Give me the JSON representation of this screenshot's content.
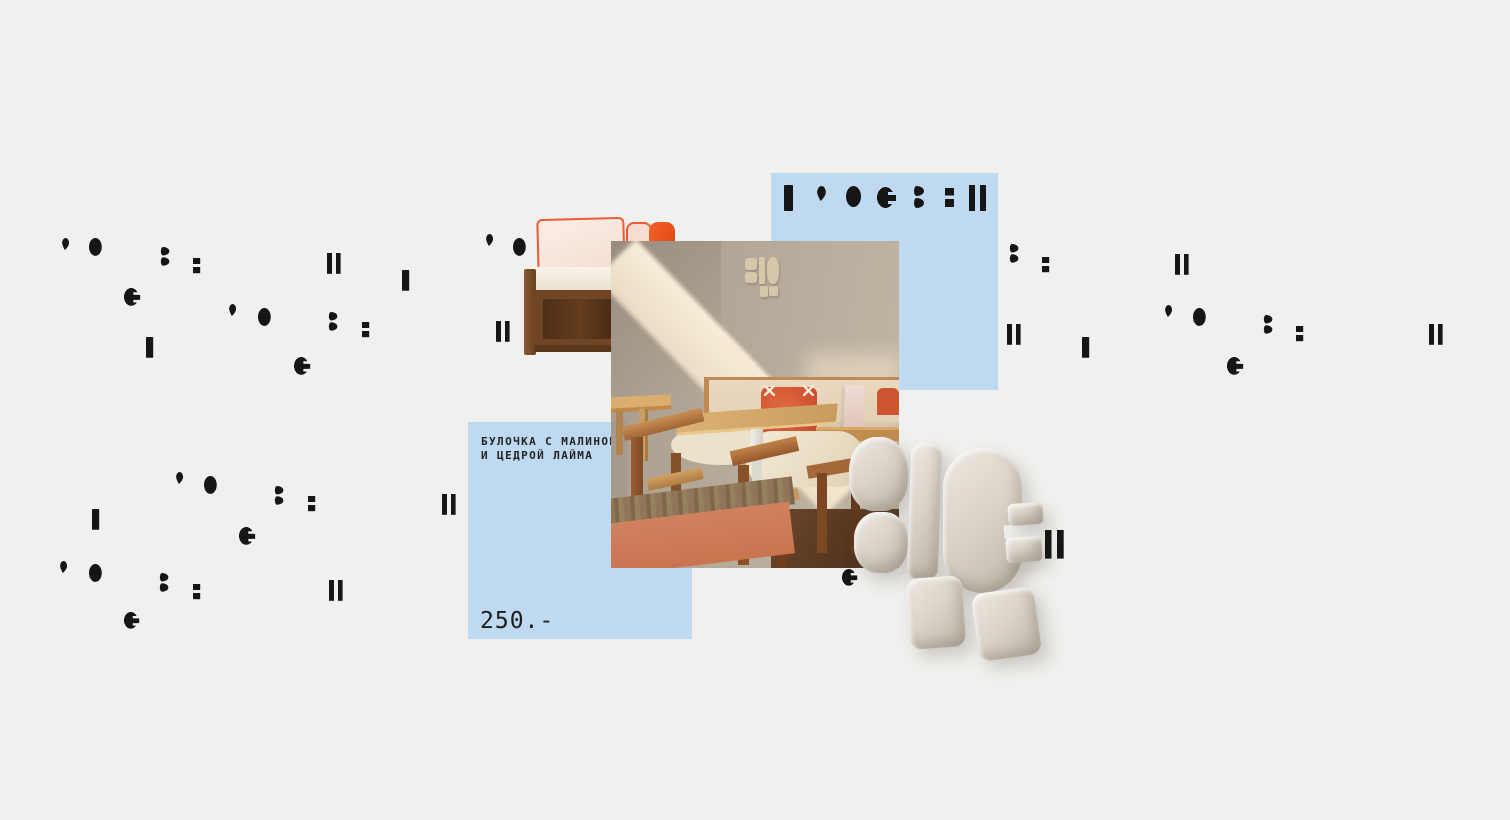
{
  "canvas": {
    "width": 1510,
    "height": 820,
    "background": "#f0f0ee"
  },
  "colors": {
    "accent_blue": "#bed9f0",
    "glyph_black": "#161616",
    "logo_beige": "#d9d2c7",
    "terracotta": "#cd7a5c",
    "wood_oak": "#a06536"
  },
  "product_card": {
    "title_line1": "БУЛОЧКА С МАЛИНОЙ,",
    "title_line2": "И ЦЕДРОЙ ЛАЙМА",
    "price": "250.-"
  },
  "glyph_types": {
    "bar": "vertical-bar-glyph",
    "dbar": "double-bar-glyph",
    "oval": "oval-dot-glyph",
    "apos": "apostrophe-glyph",
    "cnotch": "notched-circle-glyph",
    "z3": "double-comma-glyph",
    "esq": "stacked-squares-glyph"
  },
  "glyphs": [
    {
      "t": "bar",
      "x": 784,
      "y": 185,
      "s": 1
    },
    {
      "t": "apos",
      "x": 817,
      "y": 186,
      "s": 1
    },
    {
      "t": "oval",
      "x": 846,
      "y": 186,
      "s": 1
    },
    {
      "t": "cnotch",
      "x": 877,
      "y": 187,
      "s": 1,
      "blue": true
    },
    {
      "t": "z3",
      "x": 913,
      "y": 186,
      "s": 1
    },
    {
      "t": "esq",
      "x": 945,
      "y": 188,
      "s": 1
    },
    {
      "t": "dbar",
      "x": 969,
      "y": 185,
      "s": 1
    },
    {
      "t": "apos",
      "x": 62,
      "y": 238,
      "s": 0.8
    },
    {
      "t": "oval",
      "x": 89,
      "y": 238,
      "s": 0.85
    },
    {
      "t": "z3",
      "x": 160,
      "y": 247,
      "s": 0.85
    },
    {
      "t": "esq",
      "x": 193,
      "y": 258,
      "s": 0.8
    },
    {
      "t": "dbar",
      "x": 327,
      "y": 253,
      "s": 0.8
    },
    {
      "t": "bar",
      "x": 402,
      "y": 270,
      "s": 0.8
    },
    {
      "t": "cnotch",
      "x": 124,
      "y": 288,
      "s": 0.85
    },
    {
      "t": "bar",
      "x": 146,
      "y": 337,
      "s": 0.8
    },
    {
      "t": "apos",
      "x": 229,
      "y": 304,
      "s": 0.8
    },
    {
      "t": "oval",
      "x": 258,
      "y": 308,
      "s": 0.85
    },
    {
      "t": "z3",
      "x": 328,
      "y": 312,
      "s": 0.85
    },
    {
      "t": "esq",
      "x": 362,
      "y": 322,
      "s": 0.8
    },
    {
      "t": "cnotch",
      "x": 294,
      "y": 357,
      "s": 0.85
    },
    {
      "t": "apos",
      "x": 486,
      "y": 234,
      "s": 0.8
    },
    {
      "t": "oval",
      "x": 513,
      "y": 238,
      "s": 0.85
    },
    {
      "t": "dbar",
      "x": 496,
      "y": 321,
      "s": 0.8
    },
    {
      "t": "z3",
      "x": 1009,
      "y": 244,
      "s": 0.85
    },
    {
      "t": "esq",
      "x": 1042,
      "y": 257,
      "s": 0.8
    },
    {
      "t": "dbar",
      "x": 1175,
      "y": 254,
      "s": 0.8
    },
    {
      "t": "dbar",
      "x": 1007,
      "y": 324,
      "s": 0.8
    },
    {
      "t": "bar",
      "x": 1082,
      "y": 337,
      "s": 0.8
    },
    {
      "t": "apos",
      "x": 1165,
      "y": 305,
      "s": 0.8
    },
    {
      "t": "oval",
      "x": 1193,
      "y": 308,
      "s": 0.85
    },
    {
      "t": "z3",
      "x": 1263,
      "y": 315,
      "s": 0.85
    },
    {
      "t": "esq",
      "x": 1296,
      "y": 326,
      "s": 0.8
    },
    {
      "t": "cnotch",
      "x": 1227,
      "y": 357,
      "s": 0.85
    },
    {
      "t": "dbar",
      "x": 1429,
      "y": 324,
      "s": 0.8
    },
    {
      "t": "apos",
      "x": 176,
      "y": 472,
      "s": 0.8
    },
    {
      "t": "oval",
      "x": 204,
      "y": 476,
      "s": 0.85
    },
    {
      "t": "z3",
      "x": 274,
      "y": 486,
      "s": 0.85
    },
    {
      "t": "esq",
      "x": 308,
      "y": 496,
      "s": 0.8
    },
    {
      "t": "dbar",
      "x": 442,
      "y": 494,
      "s": 0.8
    },
    {
      "t": "bar",
      "x": 92,
      "y": 509,
      "s": 0.8
    },
    {
      "t": "cnotch",
      "x": 239,
      "y": 527,
      "s": 0.85
    },
    {
      "t": "apos",
      "x": 60,
      "y": 561,
      "s": 0.8
    },
    {
      "t": "oval",
      "x": 89,
      "y": 564,
      "s": 0.85
    },
    {
      "t": "z3",
      "x": 159,
      "y": 573,
      "s": 0.85
    },
    {
      "t": "esq",
      "x": 193,
      "y": 584,
      "s": 0.8
    },
    {
      "t": "dbar",
      "x": 329,
      "y": 580,
      "s": 0.8
    },
    {
      "t": "cnotch",
      "x": 124,
      "y": 612,
      "s": 0.8
    },
    {
      "t": "cnotch",
      "x": 842,
      "y": 569,
      "s": 0.8
    },
    {
      "t": "dbar",
      "x": 1045,
      "y": 530,
      "s": 1.1
    }
  ]
}
